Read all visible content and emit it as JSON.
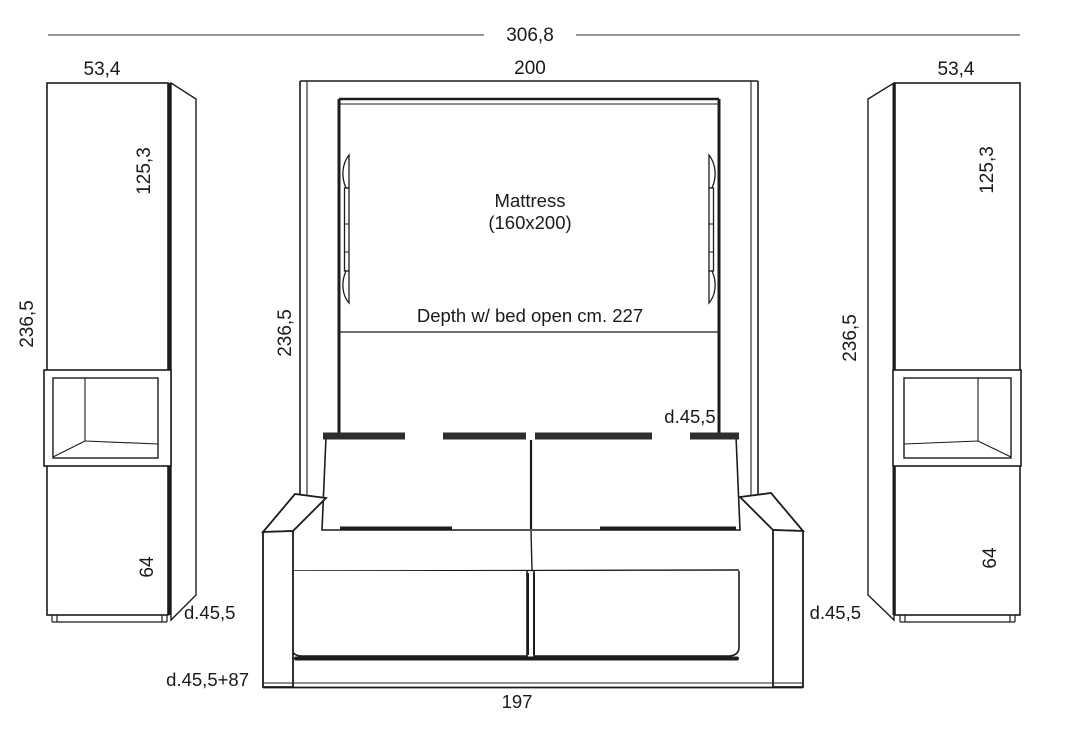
{
  "diagram": {
    "overall_width": "306,8",
    "bed": {
      "width": "200",
      "height": "236,5",
      "mattress_title": "Mattress",
      "mattress_size": "(160x200)",
      "depth_open_note": "Depth w/ bed open cm. 227",
      "depth_closed": "d.45,5"
    },
    "left_cabinet": {
      "width": "53,4",
      "upper_height": "125,3",
      "total_height": "236,5",
      "lower_height": "64",
      "depth": "d.45,5"
    },
    "right_cabinet": {
      "width": "53,4",
      "upper_height": "125,3",
      "total_height": "236,5",
      "lower_height": "64",
      "depth": "d.45,5"
    },
    "sofa": {
      "width": "197",
      "depth": "d.45,5+87"
    },
    "line_color": "#1c1c1c",
    "band_color": "#2e2e2e"
  }
}
